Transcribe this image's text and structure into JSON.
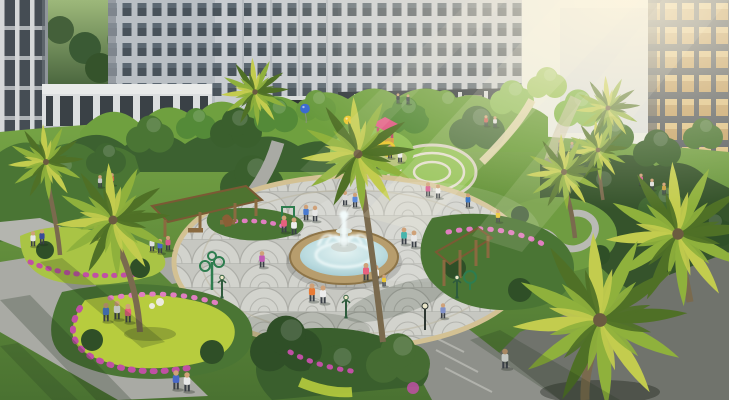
{
  "scene": {
    "type": "architectural-render",
    "description": "Aerial daytime rendering of a residential complex courtyard: a central tiered fountain on an oval fan-patterned paved plaza, surrounded by palm trees, flower gardens, pergolas, a children's playground with balloons, a circular ring lawn, winding paths with walking people, and mid-rise apartment buildings with a sky bridge, lit by warm sun rays from the upper right",
    "elements": [
      "apartment buildings",
      "sky bridge",
      "distant red roofs",
      "sun rays",
      "central fountain",
      "fan-pattern plaza",
      "palm trees",
      "round trees",
      "flower beds",
      "pergolas",
      "playground slide",
      "balloons",
      "circular lawn rings",
      "ornamental path garden",
      "street lamps",
      "outdoor gym equipment",
      "walking people",
      "jogger",
      "storefronts"
    ],
    "counts": {
      "balloons": 3,
      "pergolas": 2,
      "fountains": 1
    }
  },
  "palette": {
    "skyTop": "#e9ebe2",
    "bldgLight": "#c8ccd0",
    "bldgMid": "#b9bfc4",
    "bldgDark": "#9aa0a6",
    "facadeShade": "#6a7178",
    "winDark": "#39434b",
    "winWarm": "#c9a366",
    "bridge": "#dcdfe0",
    "roofRed": "#a8483a",
    "lawn": "#6f9c41",
    "lawnDeep": "#4a7231",
    "lawnBright": "#8fc052",
    "shrubDark": "#2f4f27",
    "shrubMid": "#4a7534",
    "treeBright": "#85b84e",
    "chartreuse": "#b7cc3e",
    "palmDark": "#4f7026",
    "palmLight": "#8fb13c",
    "palmYellow": "#c3cc4e",
    "trunk": "#7a6a4e",
    "paver": "#c6c7c1",
    "paverLine": "#adaea8",
    "stone": "#d3c193",
    "path": "#a9aaa4",
    "pathLight": "#b4b5af",
    "paveDark": "#70736c",
    "rim": "#b79d6d",
    "water": "#aed2d8",
    "waterDeep": "#8fbcc6",
    "spray": "#f2fbfb",
    "magenta": "#c050a4",
    "pinkFlower": "#e07ec0",
    "wood": "#8a6a40",
    "pergolaGreen": "#4e7330",
    "balloonBlue": "#3a6ad0",
    "balloonYellow": "#ecc832",
    "balloonPink": "#e060a8",
    "slideYellow": "#ecc832",
    "playRed": "#e05a84",
    "lampGreen": "#2e5b3c",
    "skin": "#cfa178",
    "pants": "#3a3f46",
    "glow": "#fff6df"
  }
}
